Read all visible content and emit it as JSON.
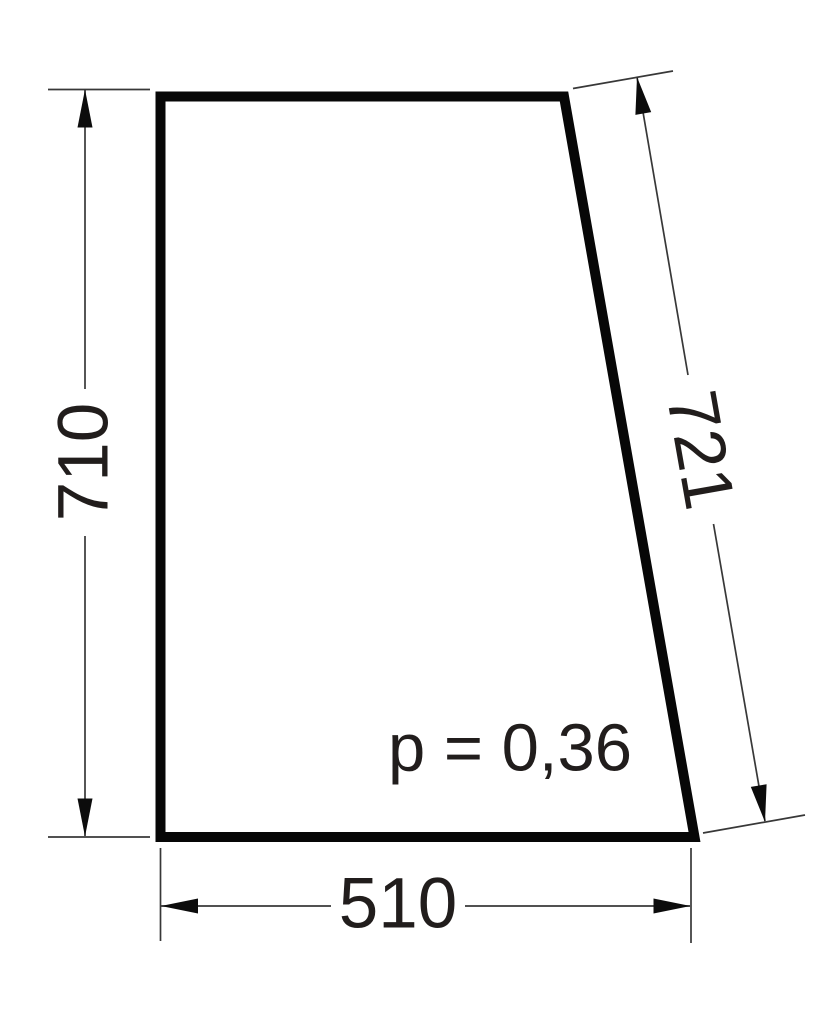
{
  "figure": {
    "label": "p = 0,36",
    "dimensions": {
      "left_height": "710",
      "slant_side": "721",
      "bottom_width": "510"
    },
    "colors": {
      "ink": "#0c0c0c",
      "text": "#211d1c",
      "background": "#ffffff"
    }
  }
}
